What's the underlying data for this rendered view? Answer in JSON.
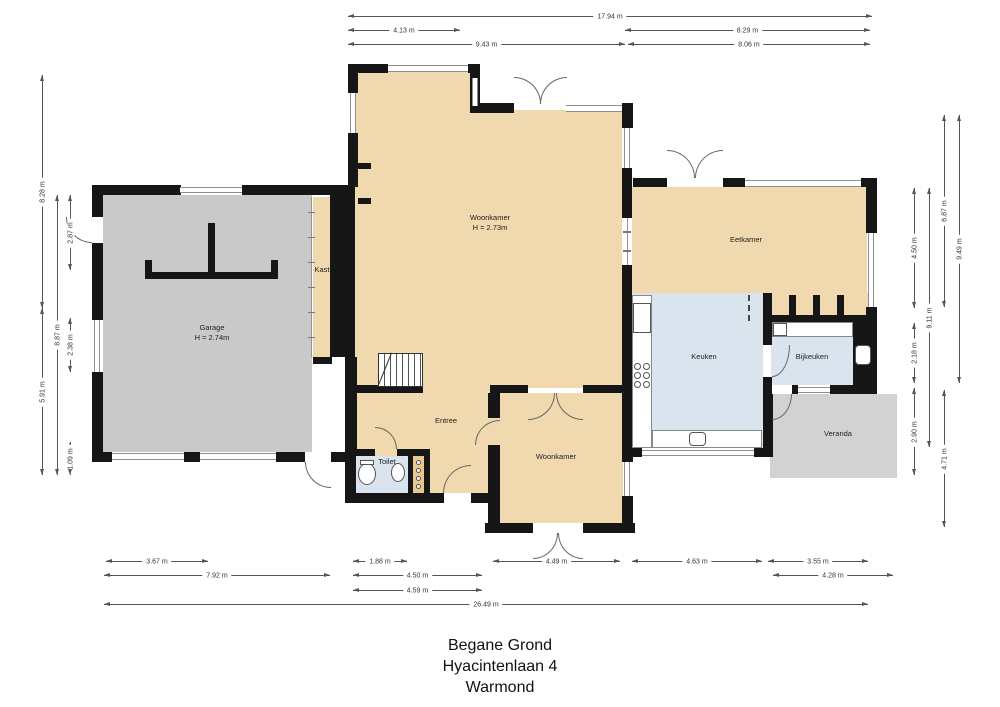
{
  "title_block": {
    "line1": "Begane Grond",
    "line2": "Hyacintenlaan 4",
    "line3": "Warmond"
  },
  "colors": {
    "floor_beige": "#f0d9ae",
    "garage_gray": "#c9c9c9",
    "veranda_gray": "#d2d2d2",
    "wet_room_blue": "#d9e4ee",
    "wall_black": "#161616"
  },
  "rooms": [
    {
      "id": "woonkamer-main",
      "label": "Woonkamer",
      "sub": "H = 2.73m",
      "cx": 490,
      "cy": 223
    },
    {
      "id": "garage",
      "label": "Garage",
      "sub": "H = 2.74m",
      "cx": 212,
      "cy": 333
    },
    {
      "id": "kast",
      "label": "Kast",
      "sub": "",
      "cx": 322,
      "cy": 270
    },
    {
      "id": "entree",
      "label": "Entree",
      "sub": "",
      "cx": 446,
      "cy": 421
    },
    {
      "id": "toilet",
      "label": "Toilet",
      "sub": "",
      "cx": 387,
      "cy": 462
    },
    {
      "id": "woonkamer-bottom",
      "label": "Woonkamer",
      "sub": "",
      "cx": 556,
      "cy": 457
    },
    {
      "id": "keuken",
      "label": "Keuken",
      "sub": "",
      "cx": 704,
      "cy": 357
    },
    {
      "id": "bijkeuken",
      "label": "Bijkeuken",
      "sub": "",
      "cx": 812,
      "cy": 357
    },
    {
      "id": "eetkamer",
      "label": "Eetkamer",
      "sub": "",
      "cx": 746,
      "cy": 240
    },
    {
      "id": "veranda",
      "label": "Veranda",
      "sub": "",
      "cx": 838,
      "cy": 434
    }
  ],
  "dimensions": {
    "horizontal": [
      {
        "label": "17.94 m",
        "x1": 348,
        "x2": 872,
        "y": 16
      },
      {
        "label": "4.13 m",
        "x1": 348,
        "x2": 460,
        "y": 30
      },
      {
        "label": "8.29 m",
        "x1": 625,
        "x2": 870,
        "y": 30
      },
      {
        "label": "9.43 m",
        "x1": 348,
        "x2": 625,
        "y": 44
      },
      {
        "label": "8.06 m",
        "x1": 628,
        "x2": 870,
        "y": 44
      },
      {
        "label": "3.67 m",
        "x1": 106,
        "x2": 208,
        "y": 561
      },
      {
        "label": "1.88 m",
        "x1": 353,
        "x2": 407,
        "y": 561
      },
      {
        "label": "4.49 m",
        "x1": 493,
        "x2": 620,
        "y": 561
      },
      {
        "label": "4.63 m",
        "x1": 632,
        "x2": 762,
        "y": 561
      },
      {
        "label": "3.55 m",
        "x1": 768,
        "x2": 868,
        "y": 561
      },
      {
        "label": "7.92 m",
        "x1": 104,
        "x2": 330,
        "y": 575
      },
      {
        "label": "4.50 m",
        "x1": 353,
        "x2": 482,
        "y": 575
      },
      {
        "label": "4.28 m",
        "x1": 773,
        "x2": 893,
        "y": 575
      },
      {
        "label": "4.59 m",
        "x1": 353,
        "x2": 482,
        "y": 590
      },
      {
        "label": "26.49 m",
        "x1": 104,
        "x2": 868,
        "y": 604
      }
    ],
    "vertical": [
      {
        "label": "8.28 m",
        "x": 42,
        "y1": 75,
        "y2": 308
      },
      {
        "label": "5.91 m",
        "x": 42,
        "y1": 308,
        "y2": 475
      },
      {
        "label": "8.87 m",
        "x": 57,
        "y1": 195,
        "y2": 475
      },
      {
        "label": "2.87 m",
        "x": 70,
        "y1": 195,
        "y2": 270
      },
      {
        "label": "2.38 m",
        "x": 70,
        "y1": 318,
        "y2": 372
      },
      {
        "label": "1.09 m",
        "x": 70,
        "y1": 442,
        "y2": 475
      },
      {
        "label": "4.50 m",
        "x": 914,
        "y1": 188,
        "y2": 308
      },
      {
        "label": "2.18 m",
        "x": 914,
        "y1": 323,
        "y2": 383
      },
      {
        "label": "2.90 m",
        "x": 914,
        "y1": 388,
        "y2": 475
      },
      {
        "label": "9.11 m",
        "x": 929,
        "y1": 188,
        "y2": 447
      },
      {
        "label": "6.87 m",
        "x": 944,
        "y1": 115,
        "y2": 307
      },
      {
        "label": "4.71 m",
        "x": 944,
        "y1": 390,
        "y2": 527
      },
      {
        "label": "9.49 m",
        "x": 959,
        "y1": 115,
        "y2": 383
      }
    ]
  }
}
